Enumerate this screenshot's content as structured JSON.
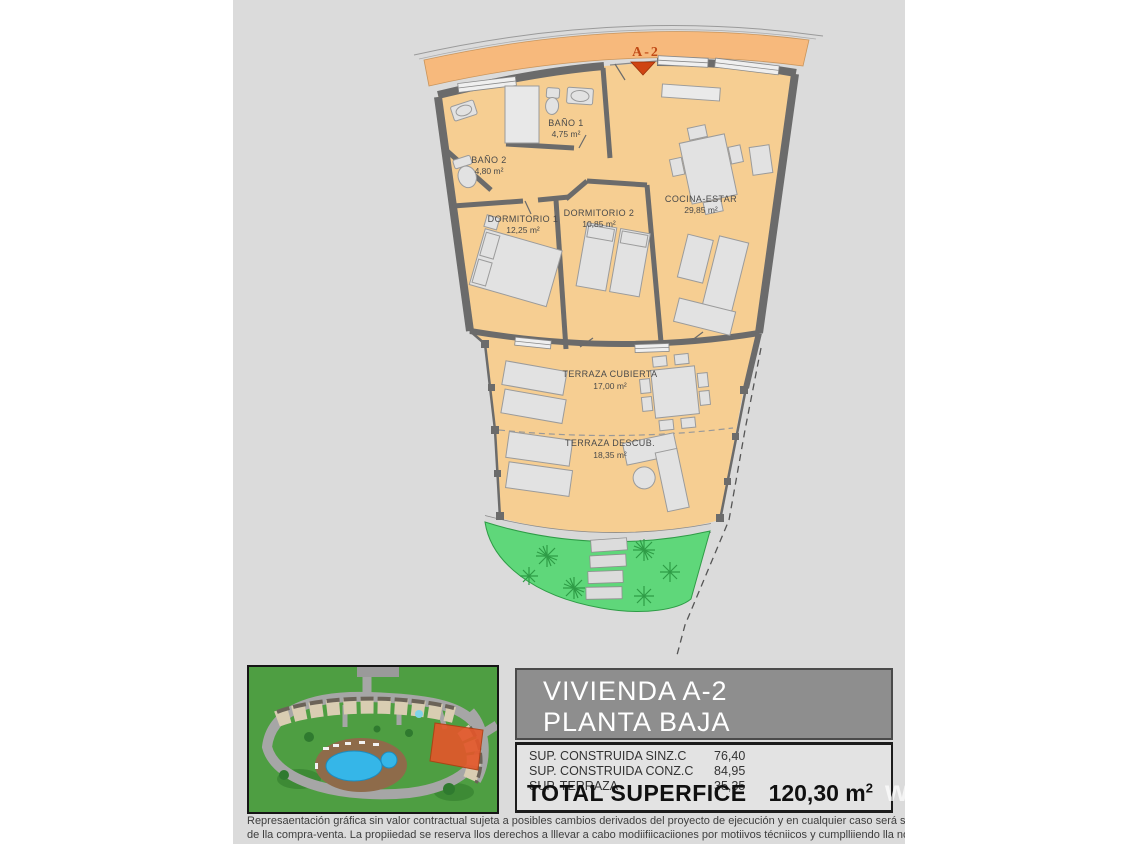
{
  "plan": {
    "unit_marker": "A-2",
    "rooms": [
      {
        "name": "BAÑO 1",
        "area": "4,75 m²"
      },
      {
        "name": "BAÑO 2",
        "area": "4,80 m²"
      },
      {
        "name": "DORMITORIO 1",
        "area": "12,25 m²"
      },
      {
        "name": "DORMITORIO 2",
        "area": "10,85 m²"
      },
      {
        "name": "COCINA-ESTAR",
        "area": "29,85 m²"
      },
      {
        "name": "TERRAZA CUBIERTA",
        "area": "17,00 m²"
      },
      {
        "name": "TERRAZA DESCUB.",
        "area": "18,35 m²"
      }
    ],
    "colors": {
      "street_band": "#f7b97c",
      "room_fill": "#f6ce92",
      "wall": "#6b6b6b",
      "garden": "#5fd77a",
      "marker_accent": "#c04a16",
      "background": "#dbdbdb"
    }
  },
  "info_panel": {
    "title_line1": "VIVIENDA A-2",
    "title_line2": "PLANTA BAJA",
    "rows": [
      {
        "label": "SUP. CONSTRUIDA SINZ.C",
        "value": "76,40"
      },
      {
        "label": "SUP. CONSTRUIDA CONZ.C",
        "value": "84,95"
      },
      {
        "label": "SUP. TERRAZA",
        "value": "35,35"
      }
    ],
    "total_label": "TOTAL SUPERFICE",
    "total_value": "120,30 m",
    "total_sup": "2",
    "header_bg": "#8e8e8e"
  },
  "watermark": "ww",
  "disclaimer": {
    "line1": "Represaentación gráfica sin valor contractual sujeta a posibles cambios derivados del proyecto de ejecución y en cualquier caso será sustituido por el definitivo er",
    "line2": "de lla compra-venta. La propiiedad se reserva llos derechos a lllevar a cabo modiifiicaciiones por motiivos técniicos y cumplliiendo lla normatiiva viigente."
  }
}
